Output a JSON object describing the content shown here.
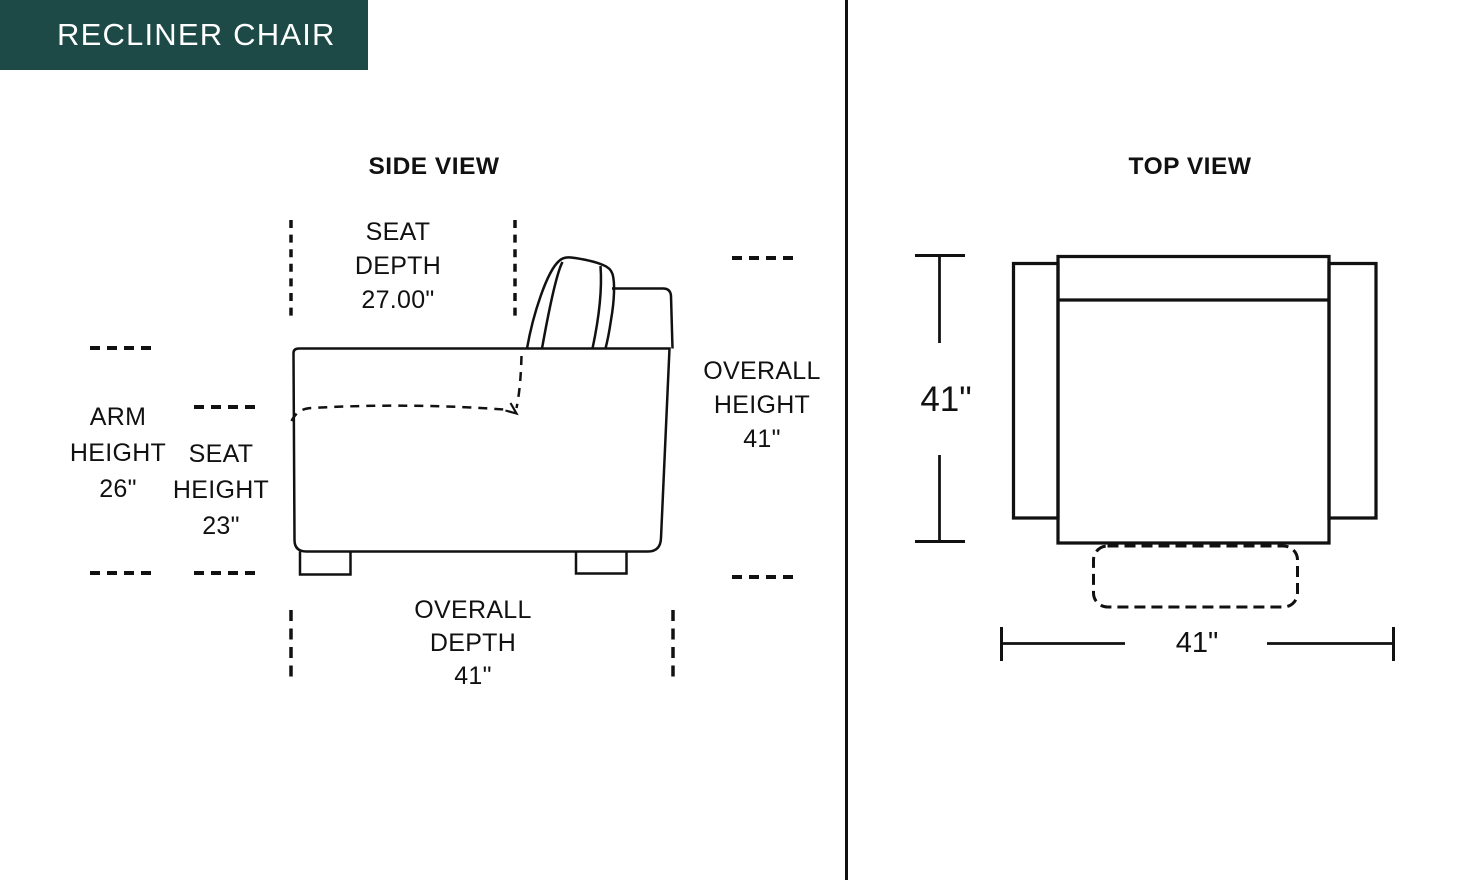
{
  "header": {
    "title": "RECLINER CHAIR"
  },
  "side_view": {
    "title": "SIDE VIEW",
    "seat_depth": [
      "SEAT",
      "DEPTH",
      "27.00\""
    ],
    "arm_height": [
      "ARM",
      "HEIGHT",
      "26\""
    ],
    "seat_height": [
      "SEAT",
      "HEIGHT",
      "23\""
    ],
    "overall_height": [
      "OVERALL",
      "HEIGHT",
      "41\""
    ],
    "overall_depth": [
      "OVERALL",
      "DEPTH",
      "41\""
    ]
  },
  "top_view": {
    "title": "TOP VIEW",
    "width_label": "41\"",
    "height_label": "41\""
  },
  "colors": {
    "header_bg": "#1d4a47",
    "header_text": "#ffffff",
    "line": "#111111",
    "background": "#ffffff"
  }
}
